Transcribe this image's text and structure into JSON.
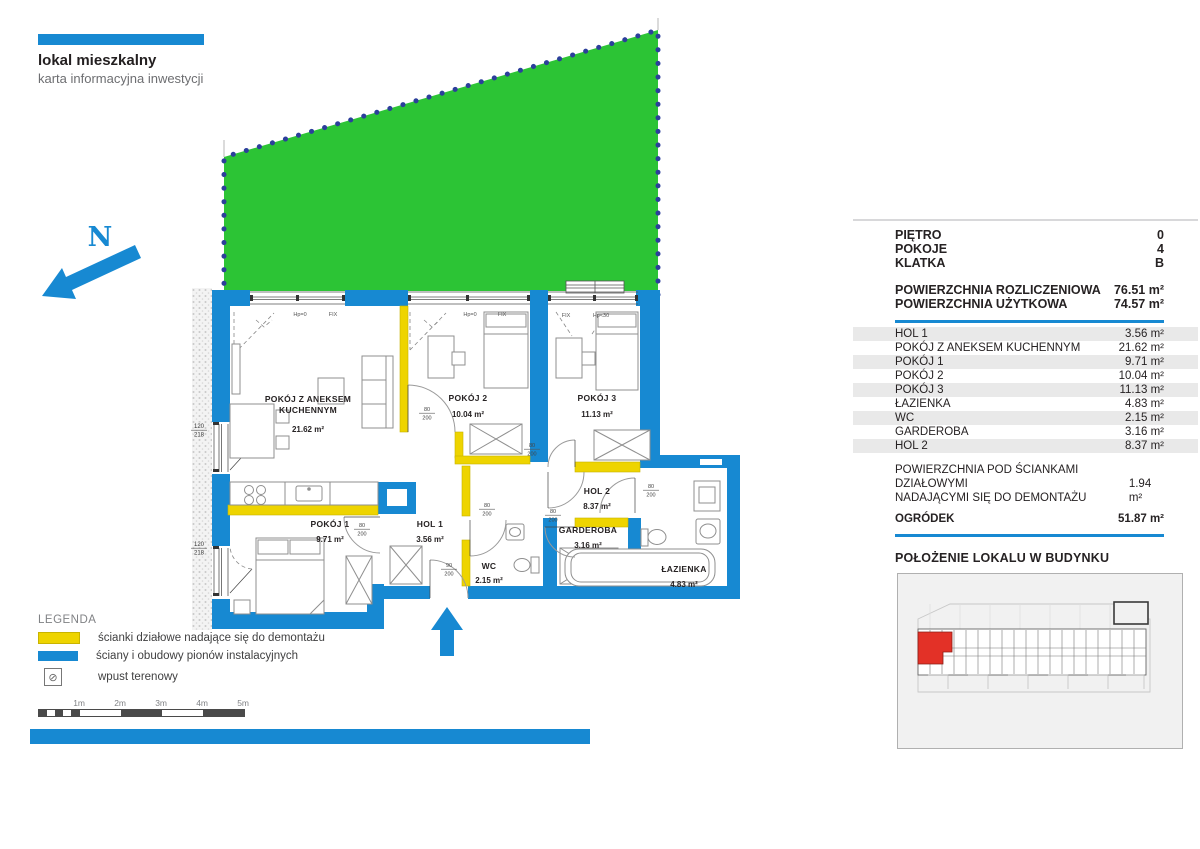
{
  "colors": {
    "blue": "#1789d2",
    "yellow": "#eed400",
    "green": "#2cc435",
    "red": "#e33127",
    "dot_navy": "#2c3f9b",
    "zebra": "#e9e9e9"
  },
  "header": {
    "title": "lokal mieszkalny",
    "subtitle": "karta informacyjna inwestycji"
  },
  "legend": {
    "title": "LEGENDA",
    "items": [
      {
        "swatch": "yellow",
        "label": "ścianki działowe nadające się do demontażu"
      },
      {
        "swatch": "blue",
        "label": "ściany i obudowy pionów instalacyjnych"
      },
      {
        "swatch": "drain-icon",
        "label": "wpust terenowy"
      }
    ],
    "drain_glyph": "⊘"
  },
  "scalebar": {
    "labels": [
      "1m",
      "2m",
      "3m",
      "4m",
      "5m"
    ]
  },
  "panel": {
    "attrs": [
      {
        "label": "PIĘTRO",
        "value": "0"
      },
      {
        "label": "POKOJE",
        "value": "4"
      },
      {
        "label": "KLATKA",
        "value": "B"
      }
    ],
    "areas": [
      {
        "label": "POWIERZCHNIA ROZLICZENIOWA",
        "value": "76.51 m²"
      },
      {
        "label": "POWIERZCHNIA UŻYTKOWA",
        "value": "74.57 m²"
      }
    ],
    "rooms": [
      {
        "name": "HOL 1",
        "area": "3.56 m²"
      },
      {
        "name": "POKÓJ Z ANEKSEM KUCHENNYM",
        "area": "21.62 m²"
      },
      {
        "name": "POKÓJ 1",
        "area": "9.71 m²"
      },
      {
        "name": "POKÓJ 2",
        "area": "10.04 m²"
      },
      {
        "name": "POKÓJ 3",
        "area": "11.13 m²"
      },
      {
        "name": "ŁAZIENKA",
        "area": "4.83 m²"
      },
      {
        "name": "WC",
        "area": "2.15 m²"
      },
      {
        "name": "GARDEROBA",
        "area": "3.16 m²"
      },
      {
        "name": "HOL 2",
        "area": "8.37 m²"
      }
    ],
    "demolition": {
      "line1": "POWIERZCHNIA POD ŚCIANKAMI DZIAŁOWYMI",
      "line2": "NADAJĄCYMI SIĘ DO DEMONTAŻU",
      "value": "1.94 m²"
    },
    "garden": {
      "label": "OGRÓDEK",
      "value": "51.87 m²"
    },
    "location_heading": "POŁOŻENIE LOKALU W BUDYNKU"
  },
  "plan": {
    "labels": [
      {
        "t": "N",
        "x": 100,
        "y": 246,
        "c": "north"
      },
      {
        "t": "POKÓJ Z ANEKSEM",
        "x": 308,
        "y": 402,
        "c": "room"
      },
      {
        "t": "KUCHENNYM",
        "x": 308,
        "y": 413,
        "c": "room"
      },
      {
        "t": "21.62 m²",
        "x": 308,
        "y": 432,
        "c": "area"
      },
      {
        "t": "POKÓJ 2",
        "x": 468,
        "y": 401,
        "c": "room"
      },
      {
        "t": "10.04 m²",
        "x": 468,
        "y": 417,
        "c": "area"
      },
      {
        "t": "POKÓJ 3",
        "x": 597,
        "y": 401,
        "c": "room"
      },
      {
        "t": "11.13 m²",
        "x": 597,
        "y": 417,
        "c": "area"
      },
      {
        "t": "POKÓJ 1",
        "x": 330,
        "y": 527,
        "c": "room"
      },
      {
        "t": "9.71 m²",
        "x": 330,
        "y": 542,
        "c": "area"
      },
      {
        "t": "HOL 1",
        "x": 430,
        "y": 527,
        "c": "room"
      },
      {
        "t": "3.56 m²",
        "x": 430,
        "y": 542,
        "c": "area"
      },
      {
        "t": "HOL 2",
        "x": 597,
        "y": 494,
        "c": "room"
      },
      {
        "t": "8.37 m²",
        "x": 597,
        "y": 509,
        "c": "area"
      },
      {
        "t": "GARDEROBA",
        "x": 588,
        "y": 533,
        "c": "room"
      },
      {
        "t": "3.16 m²",
        "x": 588,
        "y": 548,
        "c": "area"
      },
      {
        "t": "WC",
        "x": 489,
        "y": 569,
        "c": "room"
      },
      {
        "t": "2.15 m²",
        "x": 489,
        "y": 583,
        "c": "area"
      },
      {
        "t": "ŁAZIENKA",
        "x": 684,
        "y": 572,
        "c": "room"
      },
      {
        "t": "4.83 m²",
        "x": 684,
        "y": 587,
        "c": "area"
      },
      {
        "t": "Hp=0",
        "x": 300,
        "y": 316,
        "c": "win"
      },
      {
        "t": "FIX",
        "x": 333,
        "y": 316,
        "c": "win"
      },
      {
        "t": "Hp=0",
        "x": 470,
        "y": 316,
        "c": "win"
      },
      {
        "t": "FIX",
        "x": 502,
        "y": 316,
        "c": "win"
      },
      {
        "t": "FIX",
        "x": 566,
        "y": 317,
        "c": "win"
      },
      {
        "t": "Hp<30",
        "x": 601,
        "y": 317,
        "c": "win"
      }
    ],
    "fractions": [
      {
        "n": "80",
        "d": "200",
        "x": 427,
        "y": 411,
        "c": "door"
      },
      {
        "n": "80",
        "d": "200",
        "x": 532,
        "y": 447,
        "c": "door"
      },
      {
        "n": "80",
        "d": "200",
        "x": 362,
        "y": 527,
        "c": "door"
      },
      {
        "n": "90",
        "d": "200",
        "x": 449,
        "y": 567,
        "c": "door"
      },
      {
        "n": "80",
        "d": "200",
        "x": 487,
        "y": 507,
        "c": "door"
      },
      {
        "n": "80",
        "d": "200",
        "x": 553,
        "y": 513,
        "c": "door"
      },
      {
        "n": "80",
        "d": "200",
        "x": 651,
        "y": 488,
        "c": "door"
      },
      {
        "n": "120",
        "d": "218",
        "x": 199,
        "y": 428,
        "c": "dim"
      },
      {
        "n": "120",
        "d": "218",
        "x": 199,
        "y": 546,
        "c": "dim"
      }
    ]
  }
}
